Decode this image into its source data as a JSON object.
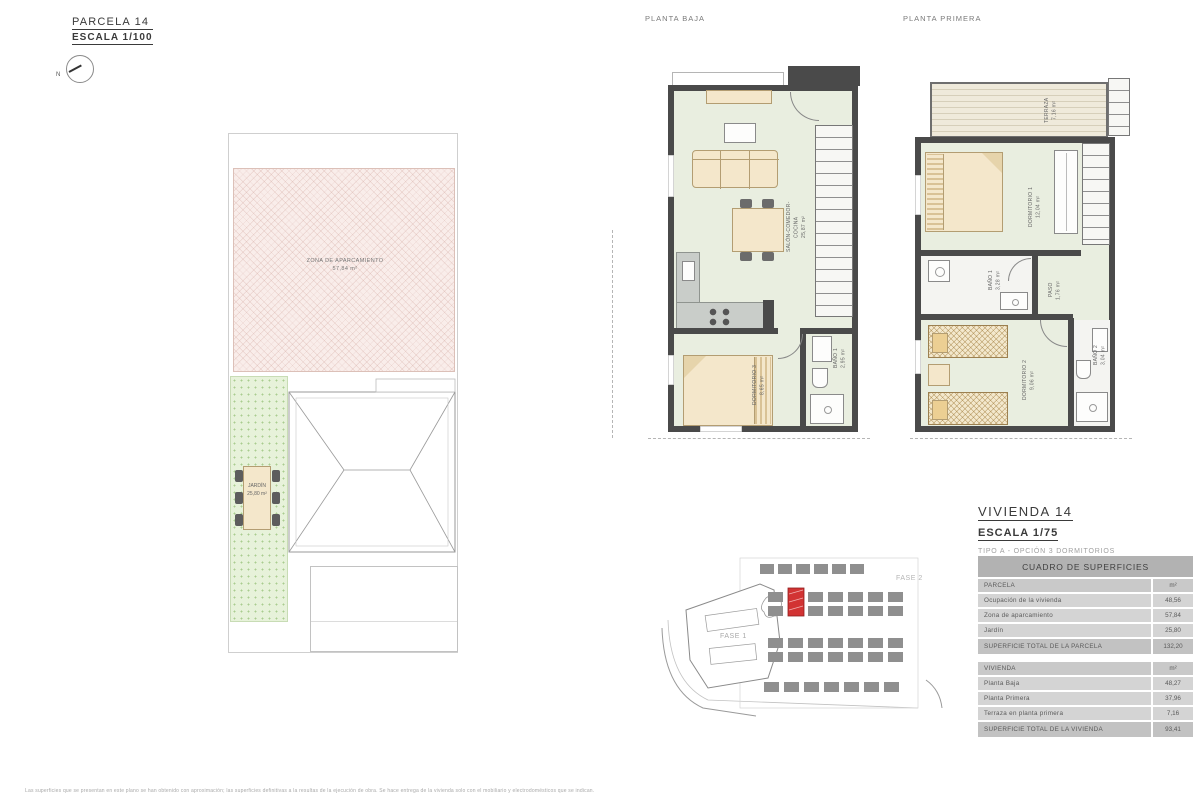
{
  "parcel_header": {
    "title": "PARCELA 14",
    "scale": "ESCALA 1/100",
    "north": "N"
  },
  "site_plan": {
    "parking_label": "ZONA DE APARCAMIENTO",
    "parking_area": "57,84 m²",
    "garden_label": "JARDÍN",
    "garden_area": "25,80 m²"
  },
  "planta_baja": {
    "title": "PLANTA BAJA",
    "salon_label": "SALÓN-COMEDOR-COCINA",
    "salon_area": "25,87 m²",
    "dorm3_label": "DORMITORIO 3",
    "dorm3_area": "8,65 m²",
    "bano1_label": "BAÑO 1",
    "bano1_area": "2,95 m²"
  },
  "planta_primera": {
    "title": "PLANTA PRIMERA",
    "terraza_label": "TERRAZA",
    "terraza_area": "7,16 m²",
    "dorm1_label": "DORMITORIO 1",
    "dorm1_area": "12,04 m²",
    "bano1_label": "BAÑO 1",
    "bano1_area": "3,28 m²",
    "paso_label": "PASO",
    "paso_area": "1,76 m²",
    "dorm2_label": "DORMITORIO 2",
    "dorm2_area": "9,06 m²",
    "bano2_label": "BAÑO 2",
    "bano2_area": "3,04 m²"
  },
  "vivienda_header": {
    "title": "VIVIENDA 14",
    "scale": "ESCALA 1/75",
    "tipo": "TIPO A - OPCIÓN 3 DORMITORIOS"
  },
  "surfaces_table": {
    "title": "CUADRO DE SUPERFICIES",
    "sections": [
      {
        "header": {
          "label": "PARCELA",
          "value": "m²"
        },
        "rows": [
          {
            "label": "Ocupación de la vivienda",
            "value": "48,56"
          },
          {
            "label": "Zona de aparcamiento",
            "value": "57,84"
          },
          {
            "label": "Jardín",
            "value": "25,80"
          }
        ],
        "total": {
          "label": "SUPERFICIE TOTAL DE LA PARCELA",
          "value": "132,20"
        }
      },
      {
        "header": {
          "label": "VIVIENDA",
          "value": "m²"
        },
        "rows": [
          {
            "label": "Planta Baja",
            "value": "48,27"
          },
          {
            "label": "Planta Primera",
            "value": "37,96"
          },
          {
            "label": "Terraza en planta primera",
            "value": "7,16"
          }
        ],
        "total": {
          "label": "SUPERFICIE TOTAL DE LA VIVIENDA",
          "value": "93,41"
        }
      }
    ]
  },
  "location_map": {
    "fase1": "FASE 1",
    "fase2": "FASE 2"
  },
  "footer": {
    "disclaimer": "Las superficies que se presentan en este plano se han obtenido con aproximación; las superficies definitivas a la resultas de la ejecución de obra. Se hace entrega de la vivienda solo con el mobiliario y electrodomésticos que se indican."
  }
}
